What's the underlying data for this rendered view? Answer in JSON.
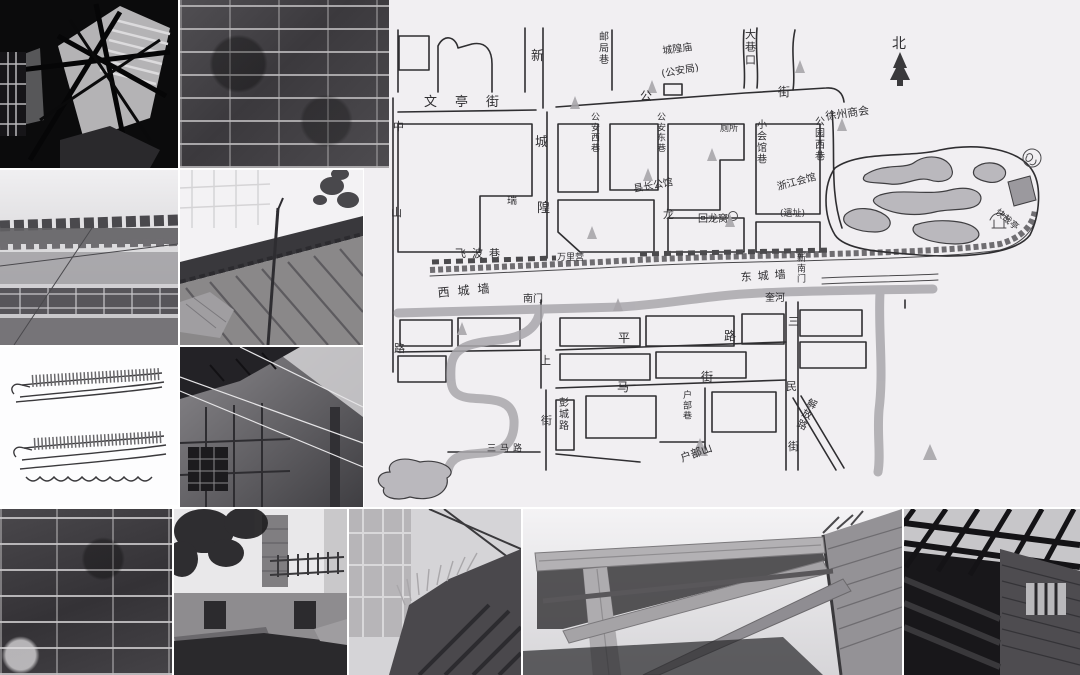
{
  "map": {
    "panel_bg": "#f1eff2",
    "ink_color": "#2f2e31",
    "shade_color": "#bab8bd",
    "title": {
      "l1": "徐州历史街区",
      "l2": "回龙窝",
      "l3": "地形示意图",
      "l4": "(20世纪40~60年代)",
      "l5": "2010.6."
    },
    "north_label": "北",
    "labels": [
      {
        "t": "文亭街",
        "x": 424,
        "y": 106,
        "s": 13,
        "ls": 18
      },
      {
        "t": "公",
        "x": 640,
        "y": 100,
        "s": 12
      },
      {
        "t": "街",
        "x": 778,
        "y": 96,
        "s": 12
      },
      {
        "t": "新",
        "x": 531,
        "y": 60,
        "s": 13
      },
      {
        "t": "城",
        "x": 535,
        "y": 146,
        "s": 13
      },
      {
        "t": "隍",
        "x": 537,
        "y": 212,
        "s": 13
      },
      {
        "t": "邮局巷",
        "x": 599,
        "y": 40,
        "s": 10,
        "v": 1
      },
      {
        "t": "大巷口",
        "x": 745,
        "y": 38,
        "s": 11,
        "v": 1
      },
      {
        "t": "城隍庙",
        "x": 663,
        "y": 54,
        "s": 10,
        "r": -8
      },
      {
        "t": "(公安局)",
        "x": 662,
        "y": 77,
        "s": 10,
        "r": -10
      },
      {
        "t": "中",
        "x": 393,
        "y": 130,
        "s": 11
      },
      {
        "t": "山",
        "x": 391,
        "y": 216,
        "s": 11
      },
      {
        "t": "路",
        "x": 394,
        "y": 352,
        "s": 11
      },
      {
        "t": "公安西巷",
        "x": 591,
        "y": 120,
        "s": 9,
        "v": 1
      },
      {
        "t": "公安东巷",
        "x": 657,
        "y": 120,
        "s": 9,
        "v": 1
      },
      {
        "t": "厕所",
        "x": 720,
        "y": 131,
        "s": 9
      },
      {
        "t": "县长公馆",
        "x": 634,
        "y": 192,
        "s": 10,
        "r": -10
      },
      {
        "t": "小会馆巷",
        "x": 757,
        "y": 128,
        "s": 10,
        "v": 1
      },
      {
        "t": "浙江会馆",
        "x": 778,
        "y": 190,
        "s": 10,
        "r": -15
      },
      {
        "t": "(遗址)",
        "x": 780,
        "y": 216,
        "s": 9
      },
      {
        "t": "公园西巷",
        "x": 815,
        "y": 125,
        "s": 10,
        "v": 1
      },
      {
        "t": "徐州商会",
        "x": 826,
        "y": 120,
        "s": 11,
        "r": -8
      },
      {
        "t": "瑞",
        "x": 507,
        "y": 204,
        "s": 10
      },
      {
        "t": "龙",
        "x": 663,
        "y": 218,
        "s": 11
      },
      {
        "t": "回龙窝",
        "x": 698,
        "y": 222,
        "s": 10
      },
      {
        "t": "飞波巷",
        "x": 455,
        "y": 257,
        "s": 11,
        "ls": 6
      },
      {
        "t": "万里营",
        "x": 557,
        "y": 260,
        "s": 9
      },
      {
        "t": "西城墙",
        "x": 438,
        "y": 297,
        "s": 12,
        "ls": 8,
        "r": -5
      },
      {
        "t": "东城墙",
        "x": 741,
        "y": 281,
        "s": 11,
        "ls": 6,
        "r": -4
      },
      {
        "t": "奎河",
        "x": 765,
        "y": 301,
        "s": 10
      },
      {
        "t": "南门",
        "x": 523,
        "y": 302,
        "s": 10
      },
      {
        "t": "新南门",
        "x": 797,
        "y": 261,
        "s": 9,
        "v": 1
      },
      {
        "t": "快哉亭",
        "x": 995,
        "y": 213,
        "s": 9,
        "r": 40
      },
      {
        "t": "平",
        "x": 618,
        "y": 342,
        "s": 12
      },
      {
        "t": "路",
        "x": 724,
        "y": 340,
        "s": 12
      },
      {
        "t": "上",
        "x": 540,
        "y": 364,
        "s": 11
      },
      {
        "t": "街",
        "x": 541,
        "y": 424,
        "s": 11
      },
      {
        "t": "马",
        "x": 617,
        "y": 391,
        "s": 12
      },
      {
        "t": "街",
        "x": 701,
        "y": 381,
        "s": 12
      },
      {
        "t": "彭城路",
        "x": 559,
        "y": 406,
        "s": 10,
        "v": 1
      },
      {
        "t": "三马路",
        "x": 487,
        "y": 451,
        "s": 9,
        "ls": 4
      },
      {
        "t": "三",
        "x": 788,
        "y": 325,
        "s": 11
      },
      {
        "t": "民",
        "x": 786,
        "y": 390,
        "s": 11
      },
      {
        "t": "街",
        "x": 788,
        "y": 450,
        "s": 11
      },
      {
        "t": "解放路",
        "x": 806,
        "y": 405,
        "s": 10,
        "v": 1,
        "r": 25
      },
      {
        "t": "户部巷",
        "x": 683,
        "y": 398,
        "s": 9,
        "v": 1
      },
      {
        "t": "户部山",
        "x": 682,
        "y": 462,
        "s": 11,
        "r": -20
      }
    ]
  }
}
